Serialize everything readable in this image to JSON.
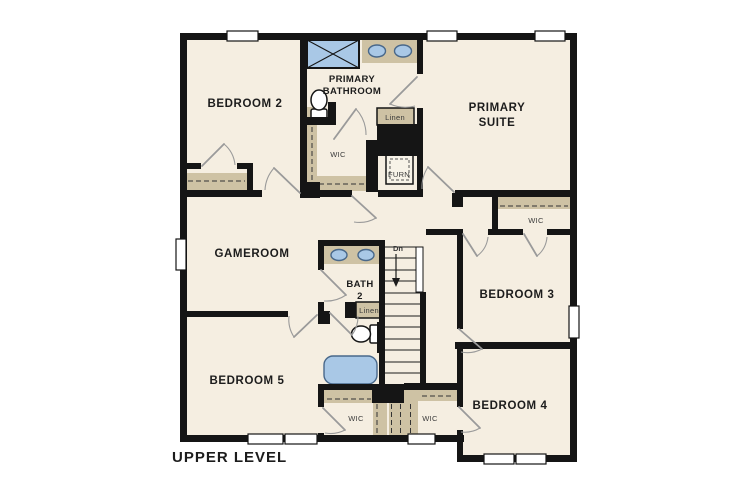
{
  "title": "UPPER LEVEL",
  "rooms": {
    "bedroom2": "BEDROOM 2",
    "primary_bathroom_line1": "PRIMARY",
    "primary_bathroom_line2": "BATHROOM",
    "primary_suite_line1": "PRIMARY",
    "primary_suite_line2": "SUITE",
    "gameroom": "GAMEROOM",
    "bath2_line1": "BATH",
    "bath2_line2": "2",
    "bedroom3": "BEDROOM 3",
    "bedroom4": "BEDROOM 4",
    "bedroom5": "BEDROOM 5"
  },
  "closets": {
    "wic_primary": "WIC",
    "wic_bedroom3": "WIC",
    "wic_bedroom5": "WIC",
    "wic_bedroom4": "WIC",
    "linen_upper": "Linen",
    "linen_bath2": "Linen"
  },
  "utility": {
    "furnace": "FURN"
  },
  "stairs": {
    "direction_label": "Dn"
  },
  "colors": {
    "floor": "#f5eee1",
    "wall": "#151515",
    "closet_shelf": "#cec2a4",
    "fixture_blue": "#a9c8e6",
    "fixture_blue_border": "#49688a",
    "door_swing": "#9a9a9a",
    "window": "#ffffff",
    "label_text": "#1c1c1c",
    "small_label_text": "#3a3a3a"
  }
}
